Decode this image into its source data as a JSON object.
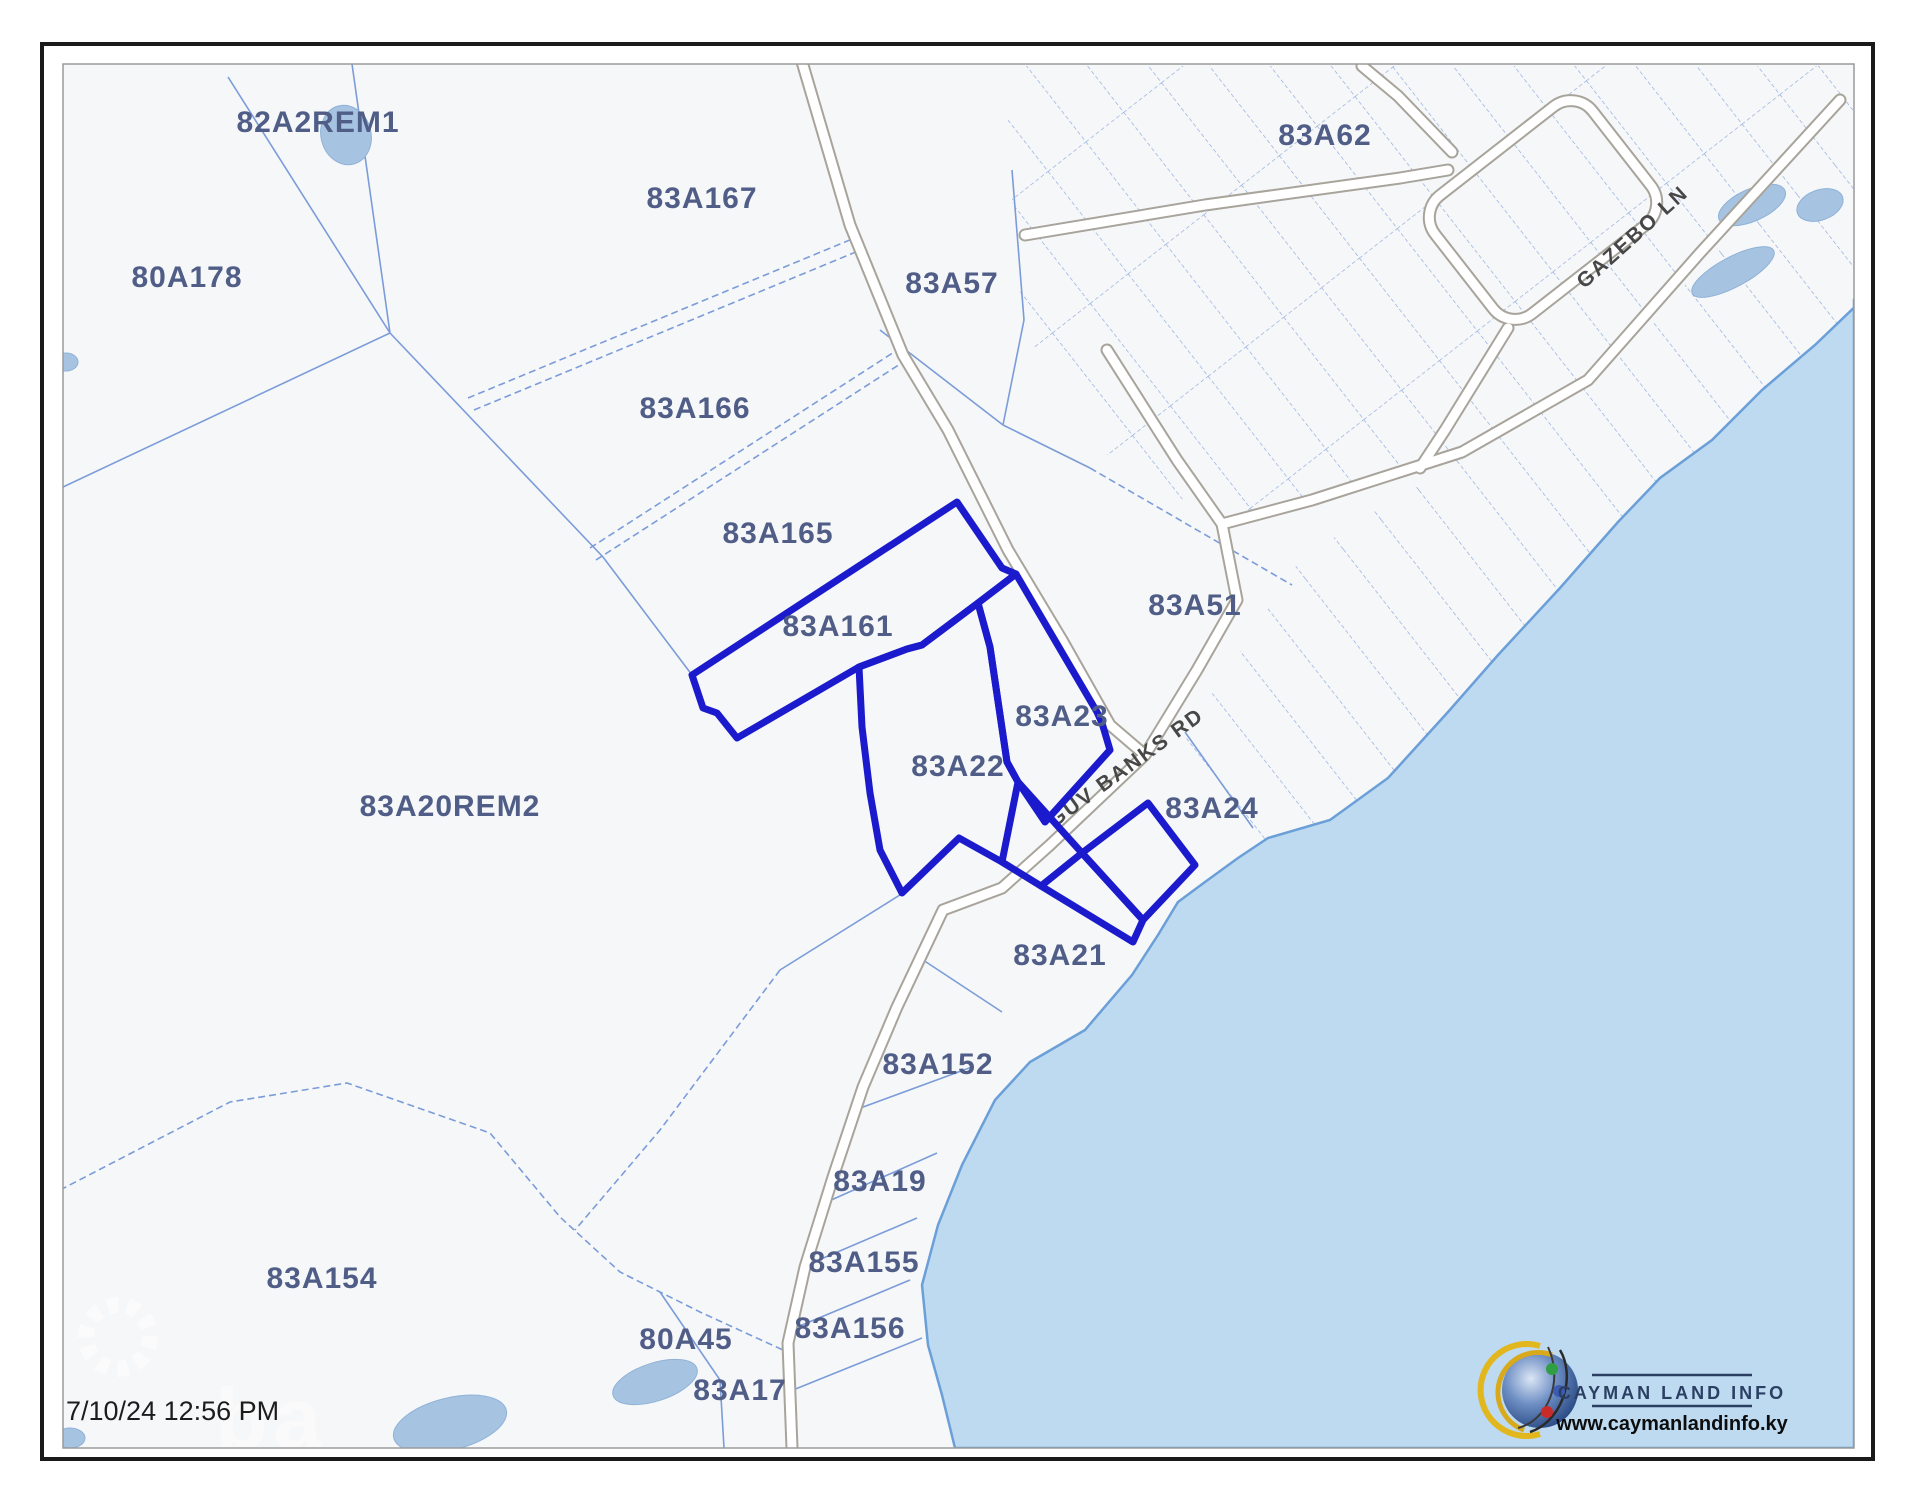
{
  "map": {
    "timestamp": "7/10/24 12:56 PM",
    "watermark": "ba",
    "logo": {
      "title": "CAYMAN LAND INFO",
      "url": "www.caymanlandinfo.ky"
    },
    "road_labels": [
      {
        "label": "GUV BANKS RD",
        "x": 1130,
        "y": 773,
        "angle": -36
      },
      {
        "label": "GAZEBO LN",
        "x": 1637,
        "y": 242,
        "angle": -42
      }
    ],
    "parcels": [
      {
        "label": "82A2REM1",
        "x": 318,
        "y": 122
      },
      {
        "label": "83A167",
        "x": 702,
        "y": 198
      },
      {
        "label": "80A178",
        "x": 187,
        "y": 277
      },
      {
        "label": "83A166",
        "x": 695,
        "y": 408
      },
      {
        "label": "83A165",
        "x": 778,
        "y": 533
      },
      {
        "label": "83A161",
        "x": 838,
        "y": 626
      },
      {
        "label": "83A57",
        "x": 952,
        "y": 283
      },
      {
        "label": "83A62",
        "x": 1325,
        "y": 135
      },
      {
        "label": "83A51",
        "x": 1195,
        "y": 605
      },
      {
        "label": "83A23",
        "x": 1062,
        "y": 716
      },
      {
        "label": "83A22",
        "x": 958,
        "y": 766
      },
      {
        "label": "83A24",
        "x": 1212,
        "y": 808
      },
      {
        "label": "83A20REM2",
        "x": 450,
        "y": 806
      },
      {
        "label": "83A21",
        "x": 1060,
        "y": 955
      },
      {
        "label": "83A152",
        "x": 938,
        "y": 1064
      },
      {
        "label": "83A19",
        "x": 880,
        "y": 1181
      },
      {
        "label": "83A155",
        "x": 864,
        "y": 1262
      },
      {
        "label": "83A156",
        "x": 850,
        "y": 1328
      },
      {
        "label": "83A154",
        "x": 322,
        "y": 1278
      },
      {
        "label": "80A45",
        "x": 686,
        "y": 1339
      },
      {
        "label": "83A17",
        "x": 740,
        "y": 1390
      }
    ],
    "colors": {
      "sea": "#bedaf0",
      "land": "#f6f7f9",
      "boundary": "#7b9cd9",
      "grid": "#8aa8dc",
      "highlight": "#1b1bcd",
      "parcel_label": "#4f5d87",
      "road_casing": "#a8a49b",
      "road_label": "#474747",
      "pond": "#a6c4e1",
      "frame": "#1a1a1a"
    }
  }
}
